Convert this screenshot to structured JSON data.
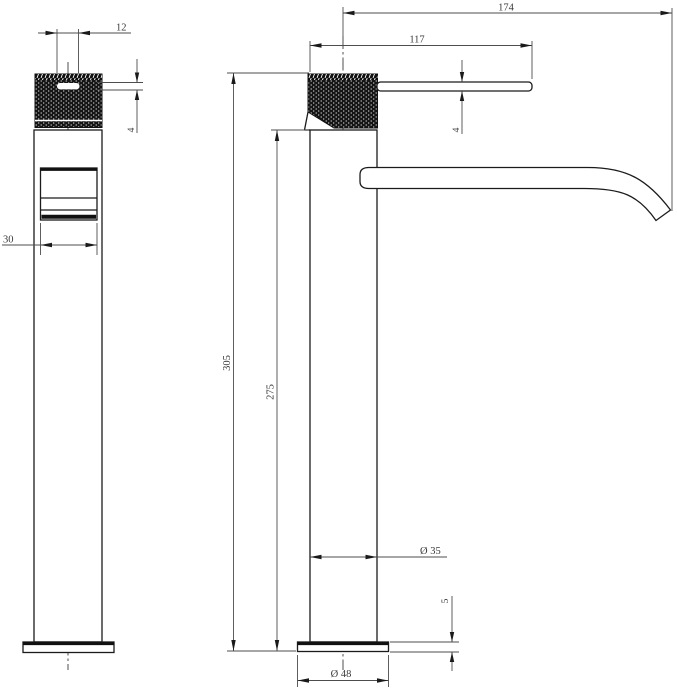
{
  "dims": {
    "slot_width": "12",
    "slot_height": "4",
    "window_width": "30",
    "spout_reach": "174",
    "handle_length": "117",
    "handle_thickness": "4",
    "overall_height": "305",
    "body_height": "275",
    "body_diameter": "Ø 35",
    "base_height": "5",
    "base_diameter": "Ø 48"
  }
}
